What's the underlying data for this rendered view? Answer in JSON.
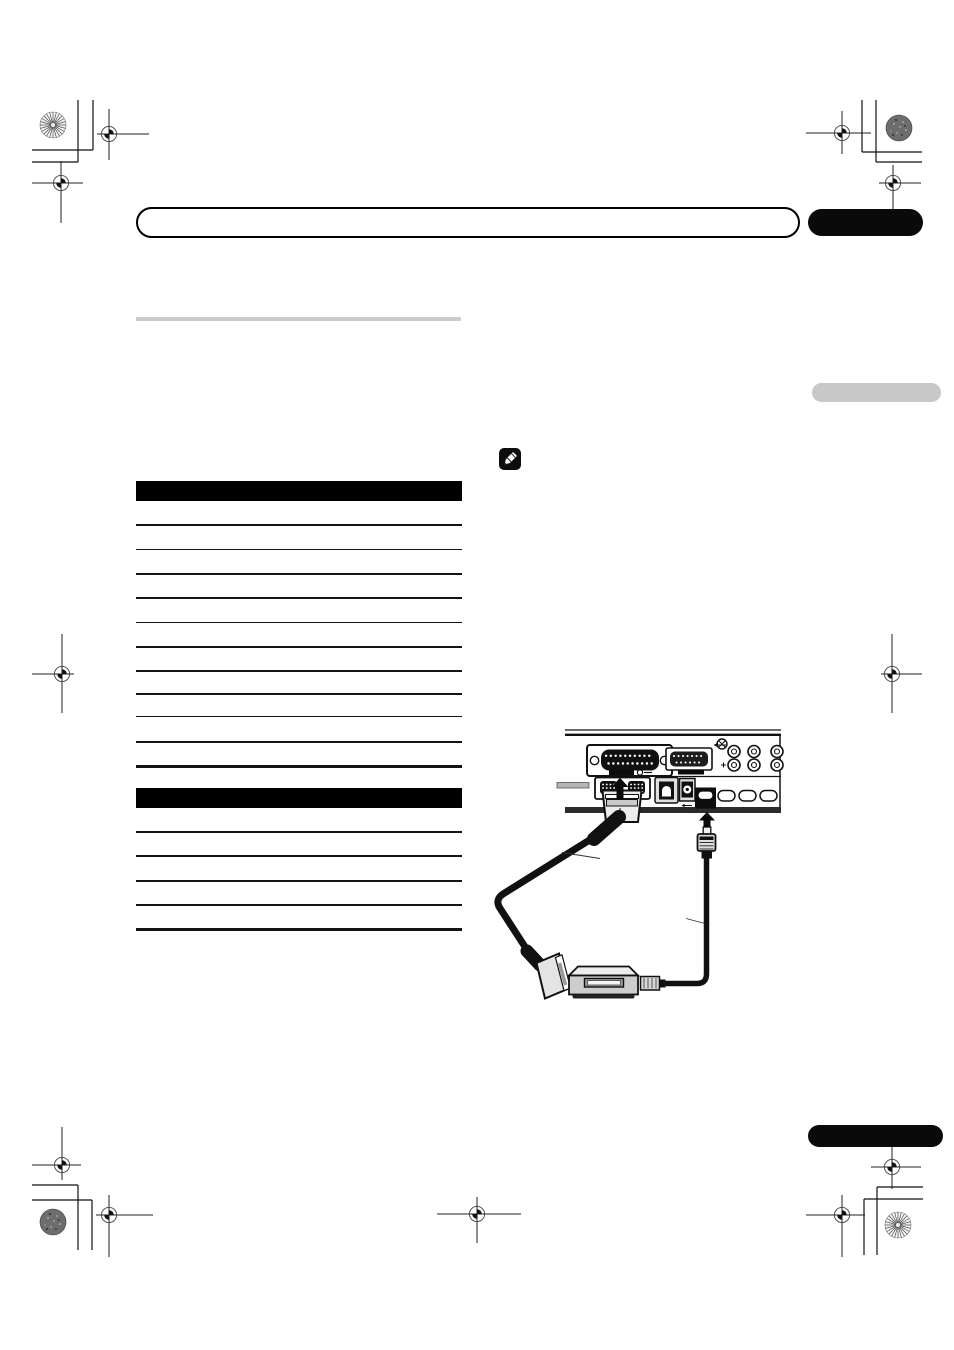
{
  "page": {
    "kind": "printed-manual-page-with-crop-marks",
    "width": 954,
    "height": 1350,
    "visible_text": ""
  },
  "colors": {
    "page_bg": "#ffffff",
    "bar_border": "#000000",
    "tab_black": "#0a0a0a",
    "tab_gray": "#c8c8c8",
    "divider_gray": "#cccccc",
    "table_header": "#000000",
    "table_line": "#141414"
  },
  "header": {
    "title_text": ""
  },
  "tables": {
    "table1": {
      "left": 136,
      "top": 481,
      "width": 325.5,
      "header_height": 19.5,
      "row_line_ys": [
        524,
        548.5,
        573,
        597,
        621.5,
        646,
        670,
        693,
        715.5,
        741
      ],
      "end_line_y": 765,
      "line_thickness": 1.8,
      "end_line_thickness": 3.2
    },
    "table2": {
      "left": 136,
      "top": 788,
      "width": 325.5,
      "header_height": 20,
      "row_line_ys": [
        831,
        855,
        880,
        904
      ],
      "end_line_y": 928,
      "line_thickness": 1.8,
      "end_line_thickness": 3.2
    }
  },
  "note": {
    "icon": "pencil-icon"
  },
  "diagram": {
    "parts": [
      "rear-panel",
      "av1-scart-connector",
      "av2-scart-connector",
      "rca-audio-jacks",
      "optical-digital-out-port",
      "coaxial-digital-out-port",
      "control-in-port",
      "scart-plug-upper",
      "scart-cable",
      "scart-plug-lower",
      "external-receiver",
      "receiver-plug",
      "control-cable",
      "control-minijack-plug"
    ]
  }
}
